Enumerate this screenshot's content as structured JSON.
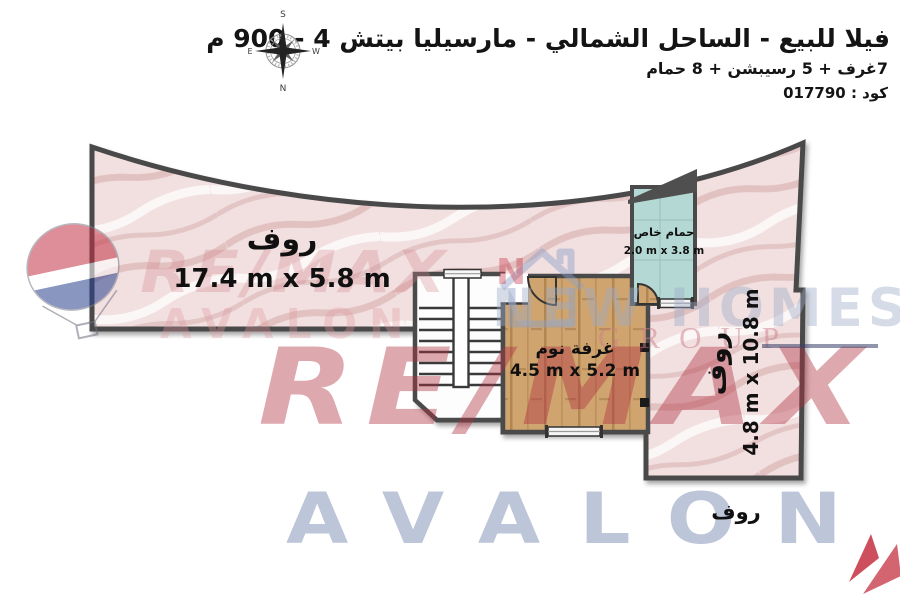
{
  "header": {
    "title": "فيلا للبيع - الساحل الشمالي - مارسيليا بيتش 4 - 900 م",
    "subtitle": "7غرف + 5 رسيبشن + 8 حمام",
    "code": "كود : 017790"
  },
  "compass": {
    "north": "N",
    "south": "S",
    "east": "E",
    "west": "W"
  },
  "rooms": {
    "roof_main": {
      "name": "روف",
      "dims": "17.4 m x 5.8 m"
    },
    "bedroom": {
      "name": "غرفة نوم",
      "dims": "4.5 m x 5.2 m"
    },
    "bathroom": {
      "name": "حمام خاص",
      "dims": "2.0 m x 3.8 m"
    },
    "roof_right": {
      "name": "روف",
      "dims": "4.8 m x 10.8 m"
    },
    "roof_bottom": {
      "name": "روف"
    }
  },
  "watermarks": {
    "remax": "RE/MAX",
    "avalon": "AVALON",
    "newhomes": "NEW HOMES",
    "group": "GROUP",
    "letter_n": "N"
  },
  "colors": {
    "roof_fill": "#f2e0e0",
    "wood_fill": "#cfa46e",
    "bath_fill": "#b4d8d3",
    "wall": "#4a4a4a",
    "remax_red": "#b03040",
    "avalon_blue": "#7a8eb2"
  }
}
